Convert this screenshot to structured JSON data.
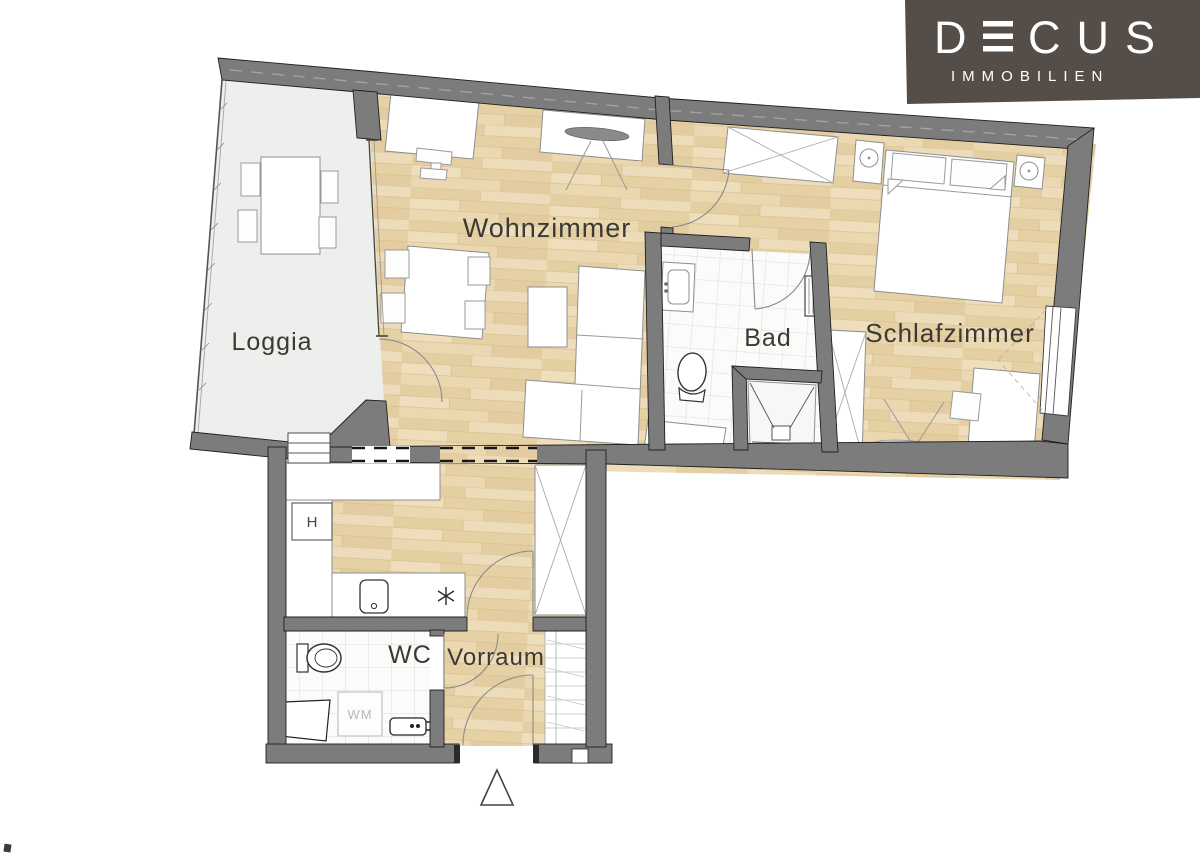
{
  "page": {
    "background": "#ffffff"
  },
  "logo": {
    "brand_d": "D",
    "brand_rest": "CUS",
    "brand_full": "DECUS",
    "subtitle": "IMMOBILIEN",
    "bg": "#554e48",
    "fg": "#ffffff"
  },
  "rooms": {
    "loggia": "Loggia",
    "wohnzimmer": "Wohnzimmer",
    "bad": "Bad",
    "schlafzimmer": "Schlafzimmer",
    "wc": "WC",
    "vorraum": "Vorraum"
  },
  "annotations": {
    "washing_machine": "WM",
    "kitchen_appliance": "H"
  },
  "colors": {
    "wall": "#7c7c7c",
    "wood_floor": "#e9d6ae",
    "loggia_floor": "#edefec",
    "tile_line": "#d9ddd9",
    "label_text": "#3b3835",
    "furniture_stroke": "#8f8f8f",
    "logo_bg": "#554e48",
    "logo_text": "#ffffff"
  }
}
